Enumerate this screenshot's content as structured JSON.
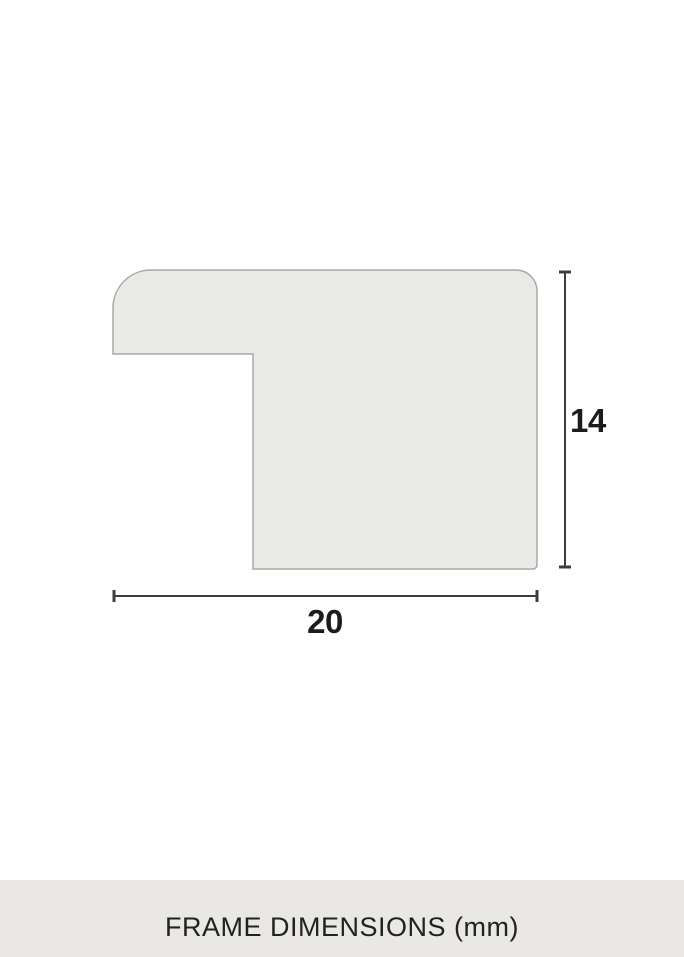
{
  "diagram": {
    "title": "frame-profile-cross-section",
    "dimensions": {
      "height_label": "14",
      "width_label": "20"
    }
  },
  "footer": {
    "title": "FRAME DIMENSIONS (mm)"
  },
  "colors": {
    "page_bg": "#ffffff",
    "shape_fill": "#e9e9e5",
    "shape_outline": "#a9a9a7",
    "dimension_line": "#3d3d3d",
    "label_text": "#1c1c1c",
    "footer_bg": "#e9e8e4",
    "footer_text": "#222222"
  }
}
